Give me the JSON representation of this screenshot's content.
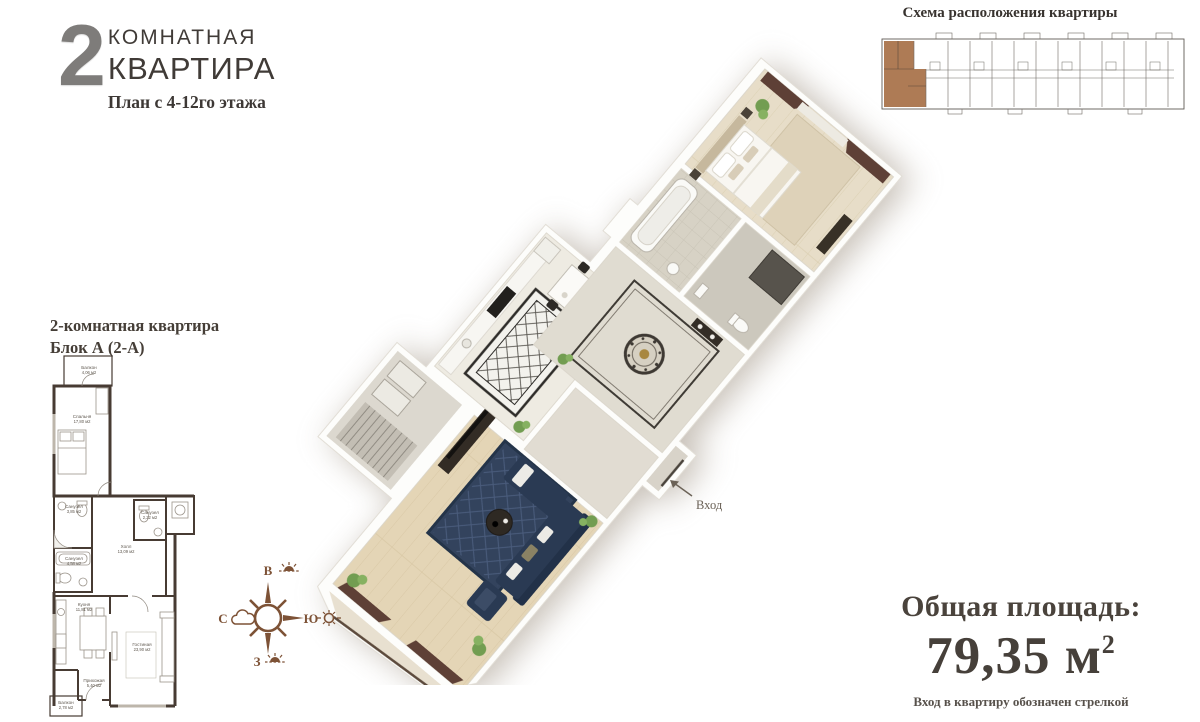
{
  "header": {
    "number": "2",
    "line1": "КОМНАТНАЯ",
    "line2": "КВАРТИРА",
    "subtitle": "План с 4-12го этажа"
  },
  "location_schema": {
    "title": "Схема расположения квартиры",
    "highlight_color": "#ae7b55"
  },
  "plan2d": {
    "title1": "2-комнатная квартира",
    "title2": "Блок А (2-А)",
    "rooms": [
      {
        "name": "Балкон",
        "area": "4,06 м2"
      },
      {
        "name": "Спальня",
        "area": "17,80 м2"
      },
      {
        "name": "Санузел",
        "area": "3,85 м2"
      },
      {
        "name": "Санузел",
        "area": "4,58 м2"
      },
      {
        "name": "Холл",
        "area": "13,09 м2"
      },
      {
        "name": "Санузел",
        "area": "2,22 м2"
      },
      {
        "name": "Кухня",
        "area": "11,81 м2"
      },
      {
        "name": "Гостиная",
        "area": "23,90 м2"
      },
      {
        "name": "Прихожая",
        "area": "5,40 м2"
      },
      {
        "name": "Балкон",
        "area": "2,78 м2"
      }
    ]
  },
  "render3d": {
    "entrance_label": "Вход"
  },
  "compass": {
    "east": "В",
    "south": "Ю",
    "west": "З",
    "north": "С"
  },
  "summary": {
    "label": "Общая площадь:",
    "value": "79,35 м",
    "sup": "2",
    "note": "Вход в квартиру обозначен стрелкой"
  },
  "colors": {
    "accent_brown": "#ae7b55",
    "compass_brown": "#7d5236",
    "text_dark": "#3e3a37",
    "sofa_navy": "#2a3a53",
    "curtain_maroon": "#5e4036"
  }
}
